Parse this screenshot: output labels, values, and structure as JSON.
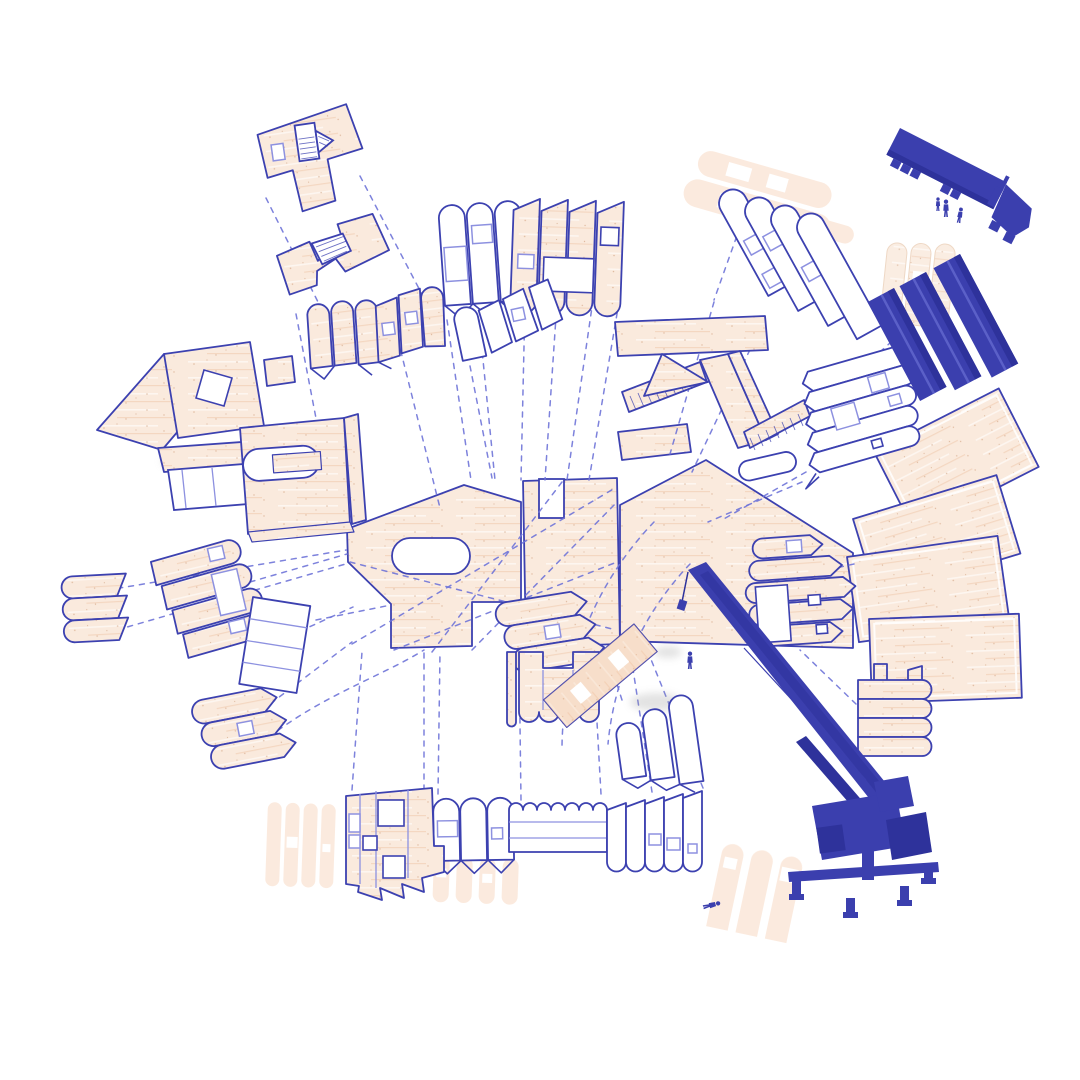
{
  "page": {
    "background": "#ffffff",
    "kind": "architectural exploded axonometric construction diagram",
    "title": "CLT kit-of-parts assembly diagram"
  },
  "palette": {
    "background": "#ffffff",
    "outline_blue": "#3c41b0",
    "light_blue": "#8d91e0",
    "dashed_blue": "#6f74d8",
    "wood_fill": "#faeadd",
    "ghost_fill": "#f9ddc9",
    "machine_blue": "#3b3fae",
    "machine_dark": "#2e329b"
  },
  "diagram": {
    "type": "exploded-axonometric",
    "connector_style": {
      "dash": "5 6"
    },
    "equipment": [
      {
        "id": "flatbed-truck",
        "count": 1
      },
      {
        "id": "panel-bundles",
        "count": 3
      },
      {
        "id": "mobile-crane",
        "count": 1
      }
    ],
    "figure_count": 5,
    "components": [
      {
        "id": "central-floor-plates",
        "label": "Central CLT floor plates",
        "style": "wood"
      },
      {
        "id": "right-floor-plate-stack",
        "label": "Stacked floor plates (right)",
        "style": "wood"
      },
      {
        "id": "upper-left-floor-plate",
        "label": "Floor plate with stair opening (upper left)",
        "style": "wood"
      },
      {
        "id": "lower-left-floor-plate",
        "label": "Floor plate with stair flight (upper left)",
        "style": "wood"
      },
      {
        "id": "arched-wall-panels-white",
        "label": "Arched wall panels, unclad",
        "style": "outline"
      },
      {
        "id": "arched-wall-panels-clad",
        "label": "Arched wall panels, timber clad",
        "style": "wood"
      },
      {
        "id": "folded-wall-panels",
        "label": "Folded wall panel strip",
        "style": "outline"
      },
      {
        "id": "arched-panel-row",
        "label": "Row of arched clad panels",
        "style": "wood"
      },
      {
        "id": "assembled-wall-module",
        "label": "Assembled timber wall module",
        "style": "wood"
      },
      {
        "id": "stair-flight-assembly",
        "label": "Stair flights and landings",
        "style": "wood"
      },
      {
        "id": "diagonal-arched-panels",
        "label": "Fanned arched panels (upper right)",
        "style": "outline"
      },
      {
        "id": "slatted-panel-stack",
        "label": "Slatted facade panel stack",
        "style": "outline"
      },
      {
        "id": "clad-strip-panels",
        "label": "Clad strip panels with door opening",
        "style": "wood"
      },
      {
        "id": "strip-stack-with-tab",
        "label": "Strip stack with tab",
        "style": "wood"
      },
      {
        "id": "small-strip-stack",
        "label": "Small strip stack (far left)",
        "style": "wood"
      },
      {
        "id": "strip-panels-with-openings",
        "label": "Strip panels with window openings",
        "style": "wood"
      },
      {
        "id": "banded-panel-outline",
        "label": "Banded panel outline",
        "style": "outline"
      },
      {
        "id": "lower-left-strip-stack",
        "label": "Strip stack (lower left)",
        "style": "wood"
      },
      {
        "id": "middle-strip-stack",
        "label": "Strip stack (centre)",
        "style": "wood"
      },
      {
        "id": "notched-scallop-panel",
        "label": "Notched panel with scalloped base",
        "style": "wood"
      },
      {
        "id": "arched-panel-trio",
        "label": "Trio of arched panels",
        "style": "outline"
      },
      {
        "id": "bottom-panel-assembly",
        "label": "Long facade assembly (bottom)",
        "style": "outline"
      },
      {
        "id": "bottom-left-wall-panels",
        "label": "Clad wall panels with windows (bottom left)",
        "style": "wood"
      },
      {
        "id": "ghost-preview-panels",
        "label": "Ghosted preview panels",
        "style": "ghost"
      },
      {
        "id": "assembly-connectors",
        "label": "Dashed assembly connectors",
        "style": "dashed"
      },
      {
        "id": "flatbed-delivery-truck",
        "label": "Flatbed delivery truck",
        "style": "machine"
      },
      {
        "id": "clt-panel-bundles",
        "label": "Bundled CLT panels",
        "style": "machine"
      },
      {
        "id": "mobile-crane",
        "label": "Mobile telescopic crane",
        "style": "machine"
      },
      {
        "id": "hoisted-panel",
        "label": "Panel being hoisted",
        "style": "wood"
      },
      {
        "id": "construction-figures",
        "label": "Construction workers",
        "style": "machine"
      }
    ]
  }
}
